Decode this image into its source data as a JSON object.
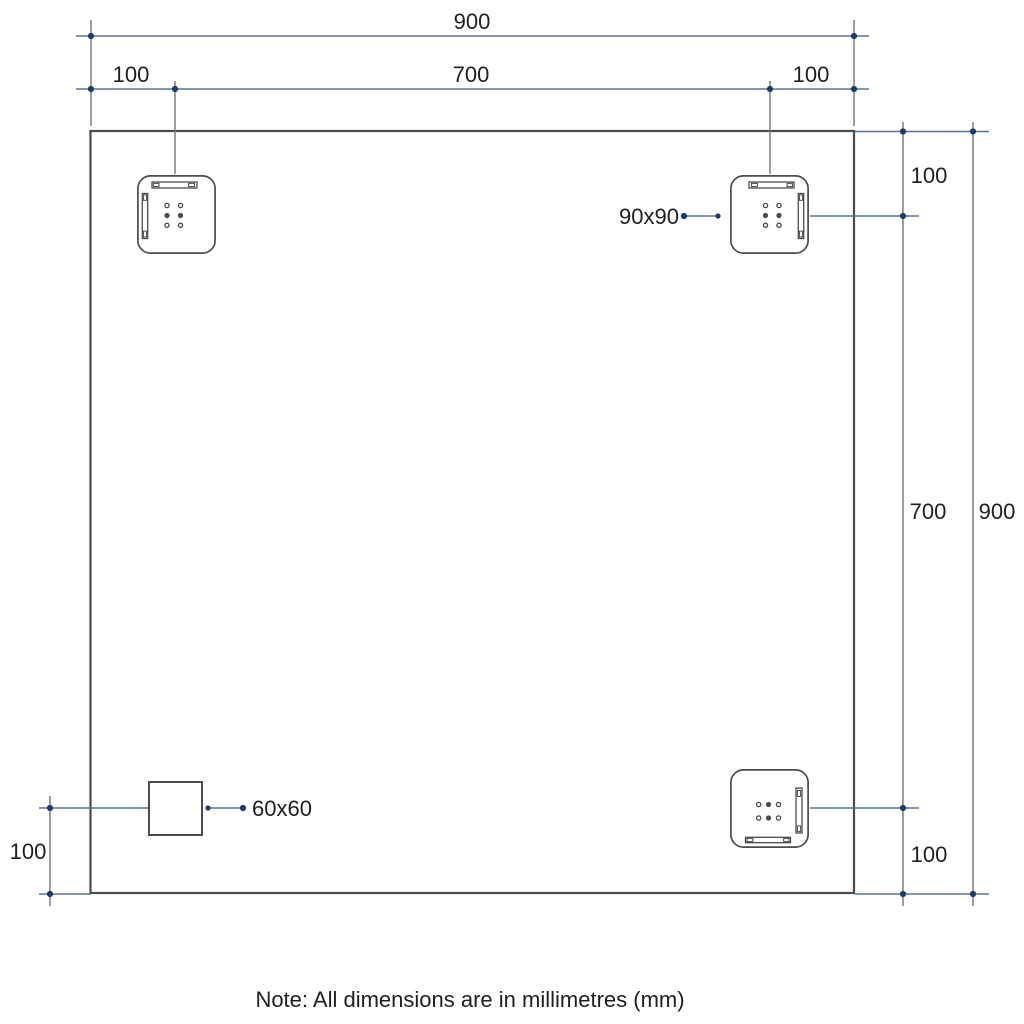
{
  "colors": {
    "background": "#ffffff",
    "dimension_line": "#5a7391",
    "dimension_dot": "#1d3a6e",
    "extension_line": "#7d7d80",
    "outline": "#4b4b4b",
    "text": "#1f1f1f"
  },
  "dimensions": {
    "top_overall": "900",
    "top_left_offset": "100",
    "top_center_span": "700",
    "top_right_offset": "100",
    "right_top_offset": "100",
    "right_center_span": "700",
    "right_overall": "900",
    "right_bottom_offset": "100",
    "left_bottom_offset": "100"
  },
  "callouts": {
    "bracket_size": "90x90",
    "plate_size": "60x60"
  },
  "note": "Note: All dimensions are in millimetres (mm)"
}
